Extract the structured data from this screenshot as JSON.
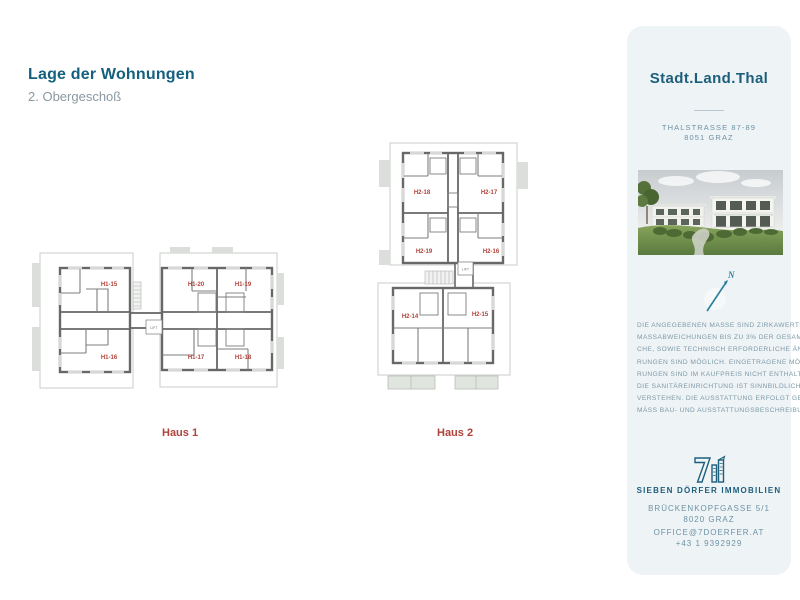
{
  "page": {
    "title": "Lage der Wohnungen",
    "subtitle": "2. Obergeschoß"
  },
  "plans": {
    "haus1": {
      "label": "Haus 1",
      "lift": "LIFT",
      "units": [
        "H1-15",
        "H1-20",
        "H1-19",
        "H1-16",
        "H1-17",
        "H1-18"
      ]
    },
    "haus2": {
      "label": "Haus 2",
      "lift": "LIFT",
      "units": [
        "H2-18",
        "H2-17",
        "H2-19",
        "H2-16",
        "H2-14",
        "H2-15"
      ]
    }
  },
  "sidebar": {
    "brand": "Stadt.Land.Thal",
    "address_line1": "THALSTRASSE 87-89",
    "address_line2": "8051 GRAZ",
    "compass_label": "N",
    "disclaimer_lines": [
      "DIE ANGEGEBENEN MASSE SIND ZIRKAWERTE.",
      "MASSABWEICHUNGEN BIS ZU 3% DER GESAMTFLÄ-",
      "CHE, SOWIE TECHNISCH ERFORDERLICHE ÄNDE-",
      "RUNGEN SIND MÖGLICH. EINGETRAGENE MÖBLIE-",
      "RUNGEN SIND IM KAUFPREIS NICHT ENTHALTEN.",
      "DIE SANITÄREINRICHTUNG IST SINNBILDLICH ZU",
      "VERSTEHEN. DIE AUSSTATTUNG ERFOLGT GE-",
      "MÄSS BAU- UND AUSSTATTUNGSBESCHREIBUNG."
    ],
    "company": "SIEBEN DÖRFER IMMOBILIEN",
    "company_address_line1": "BRÜCKENKOPFGASSE 5/1",
    "company_address_line2": "8020 GRAZ",
    "email": "OFFICE@7DOERFER.AT",
    "phone": "+43 1 9392929"
  },
  "colors": {
    "heading_teal": "#14607f",
    "brand_teal": "#1d5e7c",
    "muted_teal": "#6d92a4",
    "disclaimer_teal": "#7e99a7",
    "plan_red": "#b0423a",
    "wall_gray": "#686868",
    "sidebar_bg": "#eef3f6"
  }
}
